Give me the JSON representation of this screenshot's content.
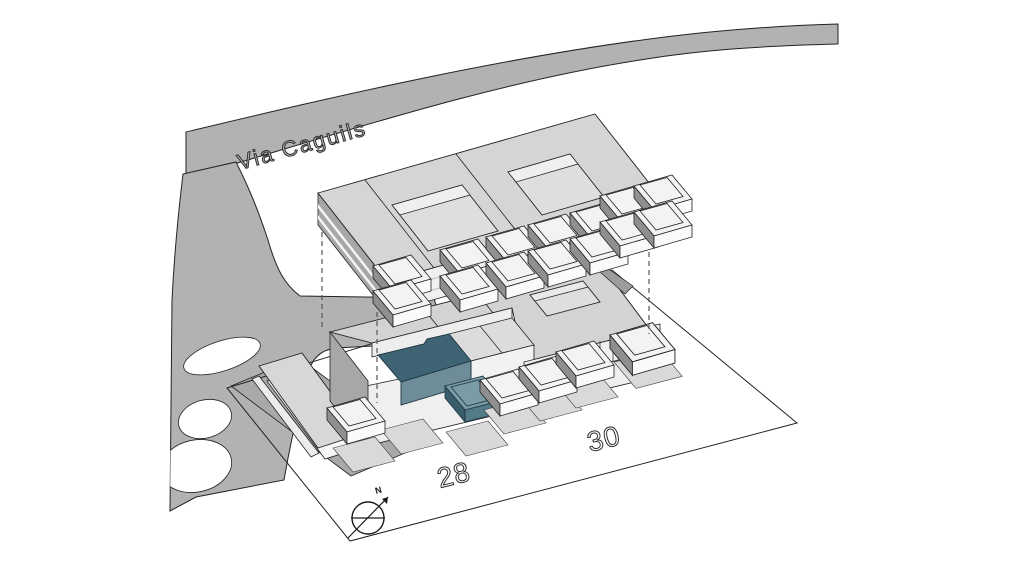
{
  "scene": {
    "kind": "architectural-site-axonometric",
    "description_elements": [
      "street",
      "footpath",
      "carport",
      "parcel-boundary",
      "lower-building",
      "upper-floor-plate",
      "highlighted-unit",
      "compass"
    ]
  },
  "labels": {
    "street": "Via Caguils",
    "number_left": "28",
    "number_right": "30",
    "compass_north": "N"
  },
  "highlighted_unit": {
    "top_color": "#3e6474",
    "front_color": "#6e8d99"
  },
  "colors": {
    "background": "#ffffff",
    "road": "#b2b2b2",
    "building_top": "#d5d5d5",
    "building_front": "#f0f0f0",
    "building_side_dark": "#a7a7a7",
    "ground_pad": "#d9d9d9",
    "highlight_top": "#3e6474",
    "highlight_front": "#6e8d99",
    "outline": "#222222"
  }
}
